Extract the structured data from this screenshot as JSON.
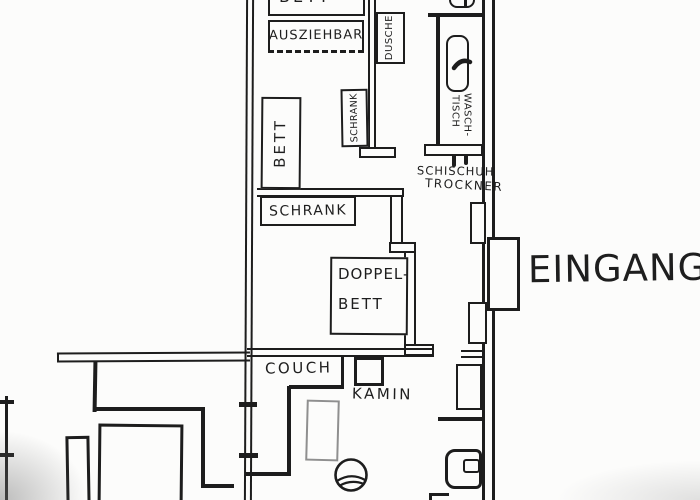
{
  "document": {
    "kind": "hand-drawn apartment floor plan sketch",
    "language": "German"
  },
  "palette": {
    "ink": "#1d1d1d",
    "pencil_gray": "#8f8f8f",
    "paper": "#fcfcfb"
  },
  "labels": {
    "bett_top": "BETT",
    "ausziehbar": "AUSZIEHBAR",
    "dusche": "DUSCHE",
    "wasch_line1": "WASCH-",
    "wasch_line2": "TISCH",
    "schrank_vertical": "SCHRANK",
    "bett_vertical": "BETT",
    "schrank_horizontal": "SCHRANK",
    "schischuh_line1": "SCHISCHUH",
    "schischuh_line2": "TROCKNER",
    "doppelbett_line1": "DOPPEL-",
    "doppelbett_line2": "BETT",
    "eingang": "EINGANG",
    "couch": "COUCH",
    "kamin": "KAMIN"
  }
}
